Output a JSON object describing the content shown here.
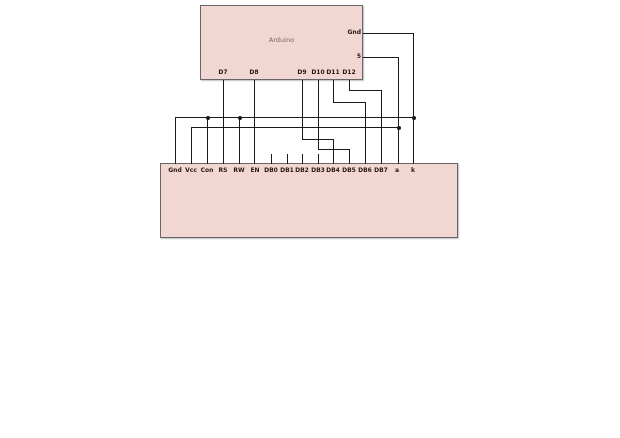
{
  "colors": {
    "background": "#ffffff",
    "component_fill": "#f2d6d2",
    "component_border": "#666666",
    "wire": "#1b1b1b",
    "pin_label": "#261812",
    "title_text": "#756260"
  },
  "arduino": {
    "label": "Arduino",
    "box": {
      "x": 200,
      "y": 5,
      "w": 163,
      "h": 75
    },
    "right_pins": [
      {
        "label": "Gnd",
        "y": 33
      },
      {
        "label": "5",
        "y": 57
      }
    ],
    "bottom_pins": [
      {
        "label": "D7",
        "x": 223
      },
      {
        "label": "D8",
        "x": 254
      },
      {
        "label": "D9",
        "x": 302
      },
      {
        "label": "D10",
        "x": 318
      },
      {
        "label": "D11",
        "x": 333
      },
      {
        "label": "D12",
        "x": 349
      }
    ]
  },
  "lcd": {
    "box": {
      "x": 160,
      "y": 163,
      "w": 298,
      "h": 75
    },
    "pins": [
      {
        "label": "Gnd",
        "x": 175
      },
      {
        "label": "Vcc",
        "x": 191
      },
      {
        "label": "Con",
        "x": 207
      },
      {
        "label": "RS",
        "x": 223
      },
      {
        "label": "RW",
        "x": 239
      },
      {
        "label": "EN",
        "x": 255
      },
      {
        "label": "DB0",
        "x": 271
      },
      {
        "label": "DB1",
        "x": 287
      },
      {
        "label": "DB2",
        "x": 302
      },
      {
        "label": "DB3",
        "x": 318
      },
      {
        "label": "DB4",
        "x": 333
      },
      {
        "label": "DB5",
        "x": 349
      },
      {
        "label": "DB6",
        "x": 365
      },
      {
        "label": "DB7",
        "x": 381
      },
      {
        "label": "a",
        "x": 397
      },
      {
        "label": "k",
        "x": 413
      }
    ]
  },
  "wires": [
    {
      "name": "arduino-gnd-to-k",
      "points": [
        [
          363,
          33
        ],
        [
          413,
          33
        ],
        [
          413,
          163
        ]
      ]
    },
    {
      "name": "gnd-bus",
      "points": [
        [
          175,
          163
        ],
        [
          175,
          117
        ],
        [
          413,
          117
        ]
      ]
    },
    {
      "name": "con-to-gnd-bus",
      "points": [
        [
          207,
          117
        ],
        [
          207,
          163
        ]
      ]
    },
    {
      "name": "rw-to-gnd-bus",
      "points": [
        [
          239,
          117
        ],
        [
          239,
          163
        ]
      ]
    },
    {
      "name": "arduino-5v-to-a",
      "points": [
        [
          363,
          57
        ],
        [
          398,
          57
        ],
        [
          398,
          163
        ]
      ]
    },
    {
      "name": "vcc-to-5v-bus",
      "points": [
        [
          191,
          163
        ],
        [
          191,
          127
        ],
        [
          398,
          127
        ]
      ]
    },
    {
      "name": "d7-to-rs",
      "points": [
        [
          223,
          80
        ],
        [
          223,
          163
        ]
      ]
    },
    {
      "name": "d8-to-en",
      "points": [
        [
          254,
          80
        ],
        [
          254,
          163
        ]
      ]
    },
    {
      "name": "d9-to-db4",
      "points": [
        [
          302,
          80
        ],
        [
          302,
          139
        ],
        [
          333,
          139
        ],
        [
          333,
          163
        ]
      ]
    },
    {
      "name": "d10-to-db5",
      "points": [
        [
          318,
          80
        ],
        [
          318,
          149
        ],
        [
          349,
          149
        ],
        [
          349,
          163
        ]
      ]
    },
    {
      "name": "d11-to-db6",
      "points": [
        [
          333,
          80
        ],
        [
          333,
          102
        ],
        [
          365,
          102
        ],
        [
          365,
          163
        ]
      ]
    },
    {
      "name": "d12-to-db7",
      "points": [
        [
          349,
          80
        ],
        [
          349,
          90
        ],
        [
          381,
          90
        ],
        [
          381,
          163
        ]
      ]
    },
    {
      "name": "db0-stub",
      "points": [
        [
          271,
          154
        ],
        [
          271,
          163
        ]
      ]
    },
    {
      "name": "db1-stub",
      "points": [
        [
          287,
          154
        ],
        [
          287,
          163
        ]
      ]
    },
    {
      "name": "db2-stub",
      "points": [
        [
          302,
          154
        ],
        [
          302,
          163
        ]
      ]
    },
    {
      "name": "db3-stub",
      "points": [
        [
          318,
          154
        ],
        [
          318,
          163
        ]
      ]
    }
  ],
  "junctions": [
    {
      "x": 207,
      "y": 117
    },
    {
      "x": 239,
      "y": 117
    },
    {
      "x": 413,
      "y": 117
    },
    {
      "x": 398,
      "y": 127
    }
  ]
}
